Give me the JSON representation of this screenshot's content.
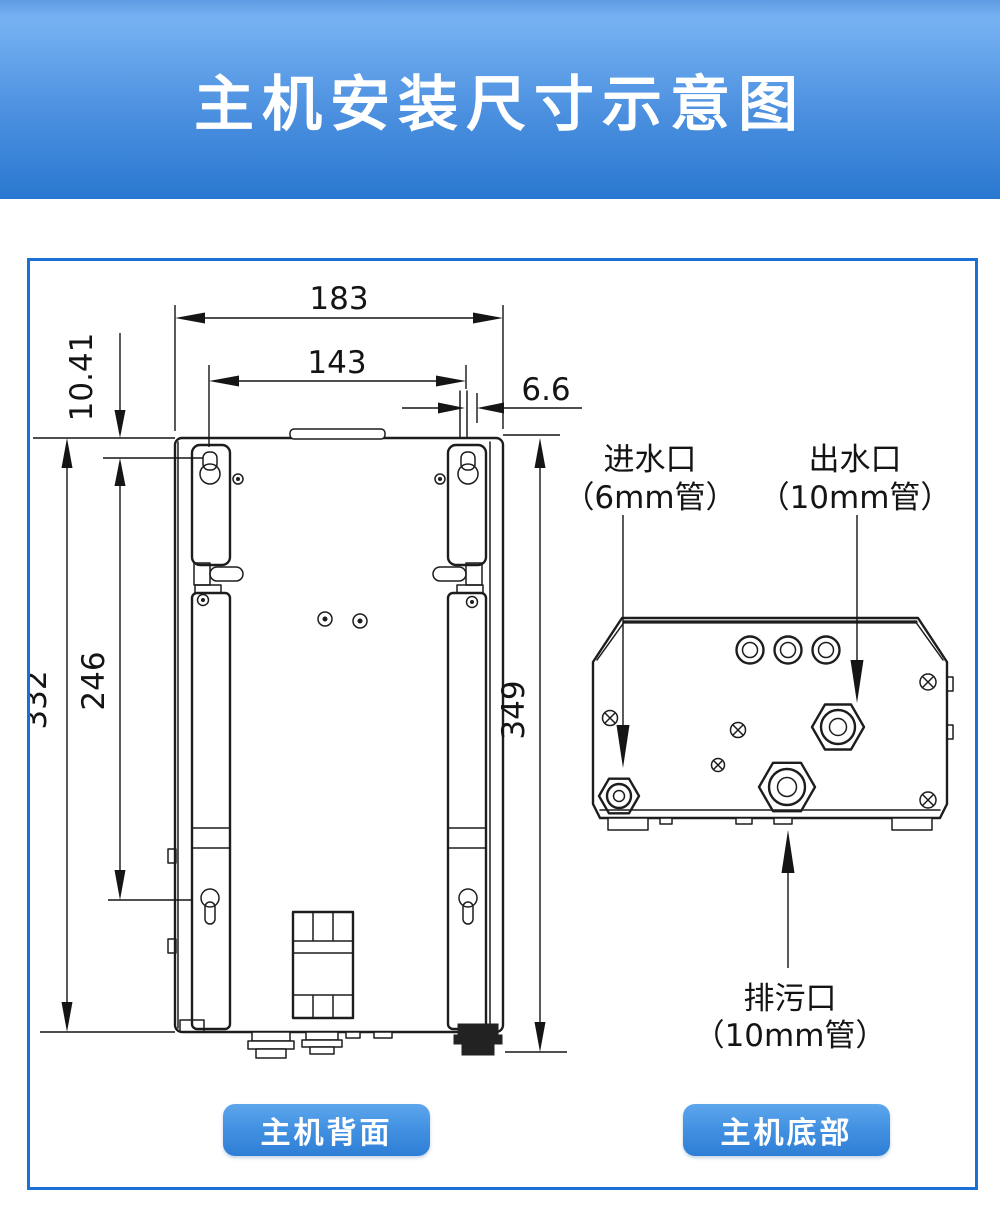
{
  "header": {
    "title": "主机安装尺寸示意图",
    "bg_top": "#77b3f3",
    "bg_bottom": "#2a78d1"
  },
  "panel": {
    "border_color": "#1b70d5"
  },
  "back_view": {
    "caption": "主机背面",
    "dims": {
      "outer_width": "183",
      "hole_span_h": "143",
      "pipe_offset": "6.6",
      "hole_top_offset": "10.41",
      "body_height": "332",
      "hole_span_v": "246",
      "total_height": "349"
    }
  },
  "bottom_view": {
    "caption": "主机底部",
    "ports": {
      "inlet": {
        "name": "进水口",
        "pipe": "（6mm管）"
      },
      "outlet": {
        "name": "出水口",
        "pipe": "（10mm管）"
      },
      "drain": {
        "name": "排污口",
        "pipe": "（10mm管）"
      }
    }
  },
  "accent": {
    "button_color": "#3b8ade"
  }
}
